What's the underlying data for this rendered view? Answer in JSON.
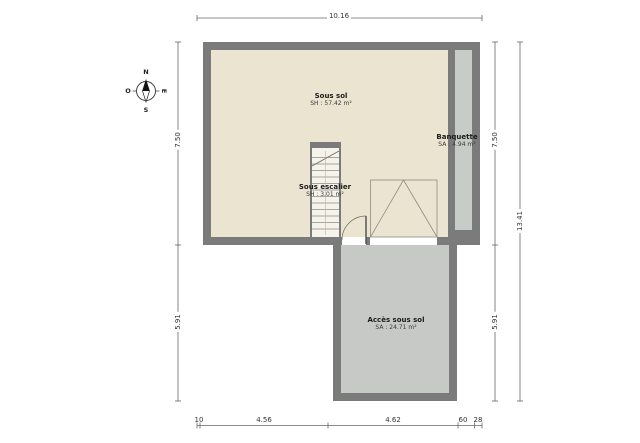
{
  "rooms": [
    {
      "name": "Sous sol",
      "area": "SH : 57.42 m²"
    },
    {
      "name": "Sous escalier",
      "area": "SH : 3.01 m²"
    },
    {
      "name": "Banquette",
      "area": "SA : 4.94 m²"
    },
    {
      "name": "Accès sous sol",
      "area": "SA : 24.71 m²"
    }
  ],
  "dimensions": {
    "top_total": "10.16",
    "left_upper": "7.50",
    "left_lower": "5.91",
    "right_upper": "7.50",
    "right_lower": "5.91",
    "right_total": "13.41",
    "bottom": [
      "10",
      "4.56",
      "4.62",
      "60",
      "28"
    ]
  },
  "compass": {
    "north": "N",
    "east": "E",
    "south": "S",
    "west": "O"
  },
  "colors": {
    "wall": "#7b7b7b",
    "main_floor": "#eae4d1",
    "banquette_floor": "#c8ccc8",
    "annex_floor": "#c6c9c6",
    "opening": "#ffffff",
    "line": "#666666"
  }
}
